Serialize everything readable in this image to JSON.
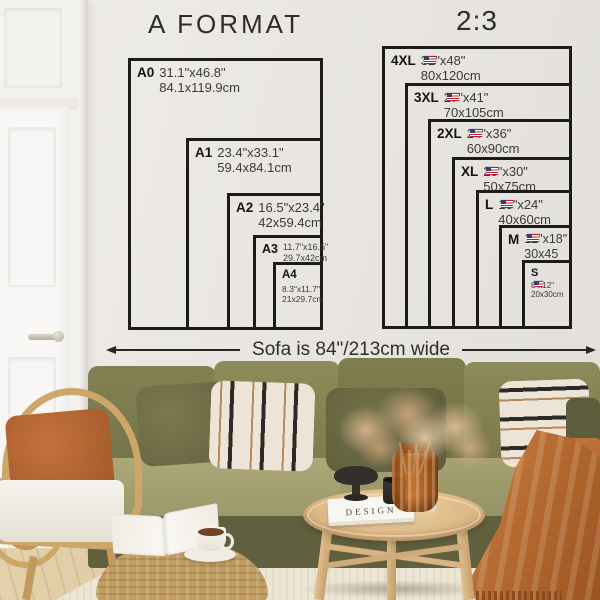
{
  "left_chart": {
    "title": "A FORMAT",
    "sizes": [
      {
        "label": "A0",
        "inches": "31.1\"x46.8\"",
        "cm": "84.1x119.9cm"
      },
      {
        "label": "A1",
        "inches": "23.4\"x33.1\"",
        "cm": "59.4x84.1cm"
      },
      {
        "label": "A2",
        "inches": "16.5\"x23.4\"",
        "cm": "42x59.4cm"
      },
      {
        "label": "A3",
        "inches": "11.7\"x16.5\"",
        "cm": "29.7x42cm"
      },
      {
        "label": "A4",
        "inches": "8.3\"x11.7\"",
        "cm": "21x29.7cm"
      }
    ]
  },
  "right_chart": {
    "title": "2:3",
    "flag_icon": "us-flag",
    "sizes": [
      {
        "label": "4XL",
        "inches": "32\"x48\"",
        "cm": "80x120cm"
      },
      {
        "label": "3XL",
        "inches": "27\"x41\"",
        "cm": "70x105cm"
      },
      {
        "label": "2XL",
        "inches": "24\"x36\"",
        "cm": "60x90cm"
      },
      {
        "label": "XL",
        "inches": "20\"x30\"",
        "cm": "50x75cm"
      },
      {
        "label": "L",
        "inches": "16\"x24\"",
        "cm": "40x60cm"
      },
      {
        "label": "M",
        "inches": "12\"x18\"",
        "cm": "30x45"
      },
      {
        "label": "S",
        "inches": "8\"x12\"",
        "cm": "20x30cm"
      }
    ]
  },
  "sofa_note": {
    "label": "Sofa is 84\"/213cm wide"
  },
  "scene": {
    "book_title": "DESIGN"
  },
  "colors": {
    "line": "#1b1b1b",
    "sofa_olive": "#7e7c50",
    "rust": "#b56a30",
    "wall": "#e9e6e2"
  }
}
